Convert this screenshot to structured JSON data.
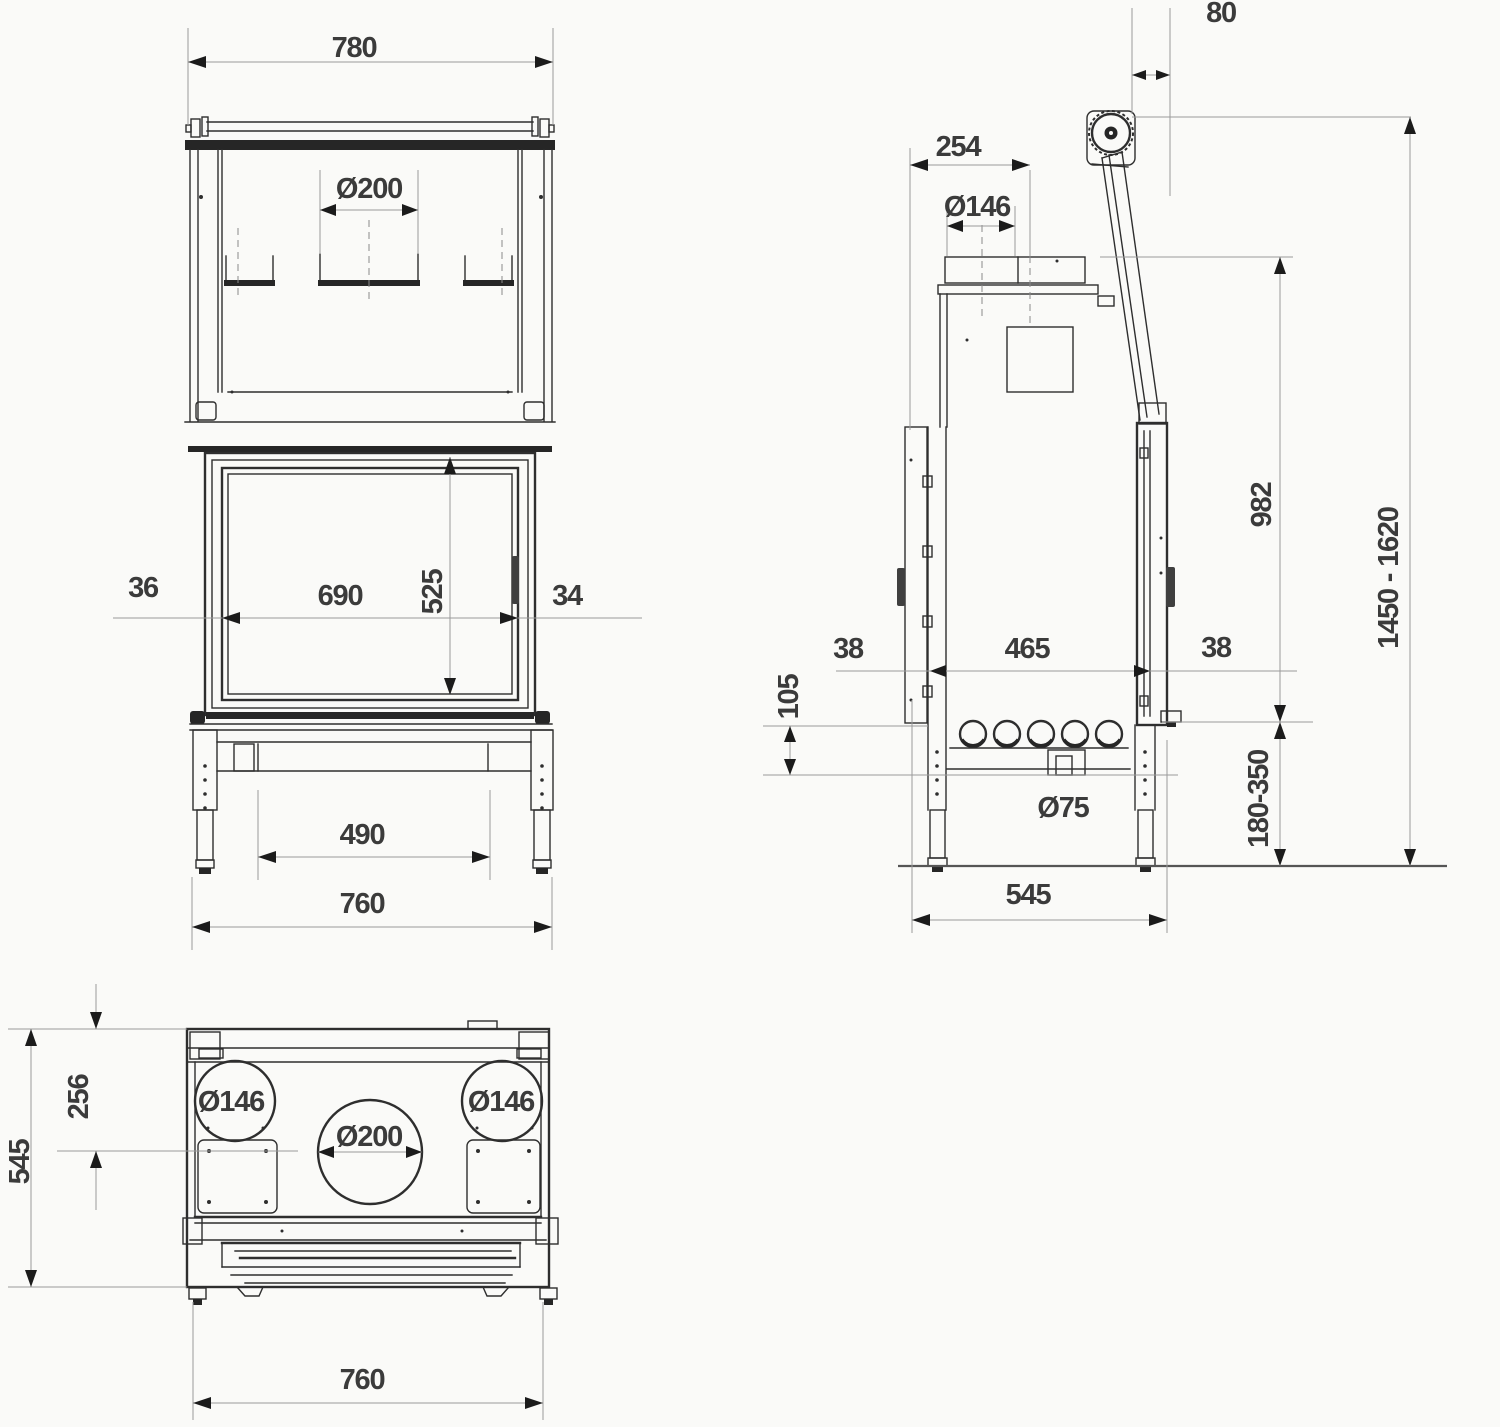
{
  "drawing": {
    "type": "fireplace insert dimension drawing, three orthographic views",
    "background_color": "#fafaf8",
    "line_color": "#2e2e2e",
    "dimension_line_color": "#9a9a9a",
    "text_color": "#3b3b3b"
  },
  "front_view": {
    "width_top": "780",
    "flue_diameter": "Ø200",
    "frame_left": "36",
    "glass_width": "690",
    "glass_height": "525",
    "frame_right": "34",
    "leg_spacing": "490",
    "width_base": "760"
  },
  "side_view": {
    "rail_top_offset": "80",
    "flue_center_from_back": "254",
    "flue_pipe_diameter": "Ø146",
    "body_height": "982",
    "total_height_range": "1450 - 1620",
    "gap_back": "38",
    "leg_spacing": "465",
    "gap_front": "38",
    "plinth_height": "105",
    "air_connector_diameter": "Ø75",
    "leg_adjust_range": "180-350",
    "base_depth": "545"
  },
  "top_view": {
    "flue_center_from_back": "256",
    "depth": "545",
    "duct_left_diameter": "Ø146",
    "flue_diameter": "Ø200",
    "duct_right_diameter": "Ø146",
    "width_base": "760"
  }
}
